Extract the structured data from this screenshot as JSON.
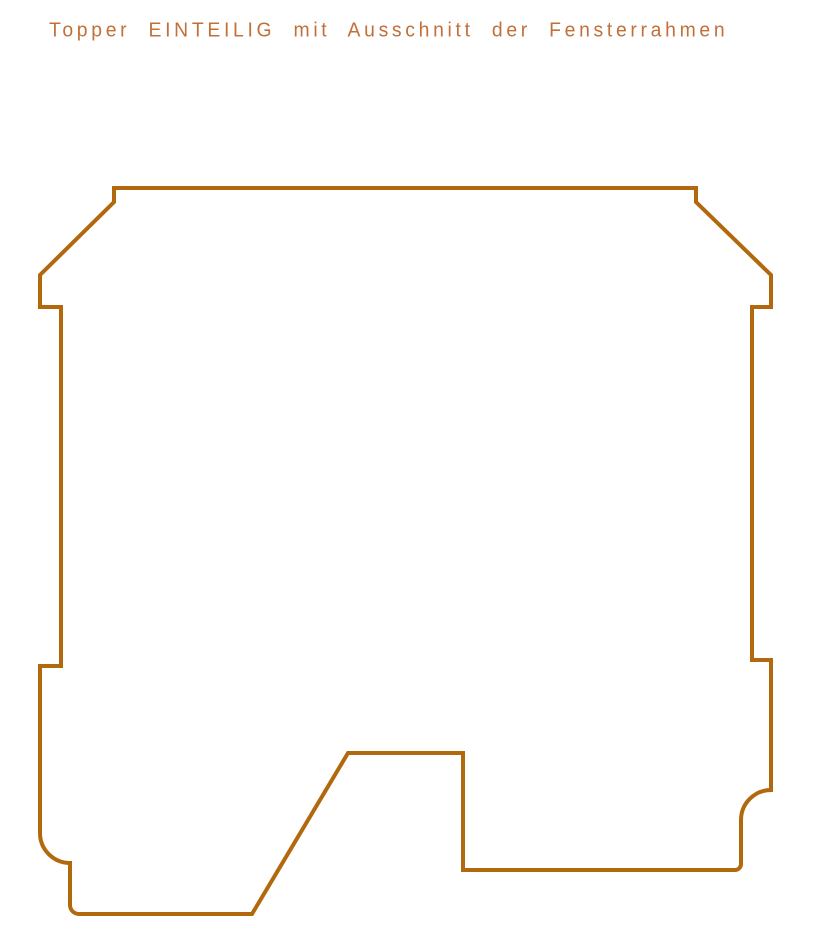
{
  "title": {
    "text": "Topper EINTEILIG mit Ausschnitt der Fensterrahmen",
    "color": "#c1703a"
  },
  "drawing": {
    "description": "Topper outline, one piece, with window-frame cutout notches",
    "stroke_color": "#b2690e",
    "stroke_width": "4",
    "path": "M 114 188 H 696 V 202 L 771 275 V 307 H 752 V 660 H 771 V 790 A 30 30 0 0 0 741 820 V 864 A 6 6 0 0 1 735 870 H 463 V 753 H 348 L 252 914 H 79 A 9 9 0 0 1 70 905 V 863 A 30 30 0 0 1 40 833 V 666 H 61 V 307 H 40 V 275 L 114 202 Z"
  }
}
